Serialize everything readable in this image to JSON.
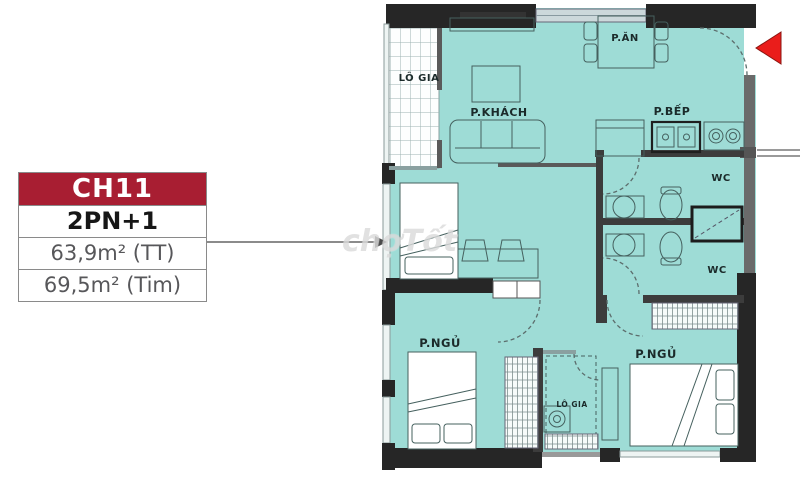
{
  "watermark": "chợTốt",
  "unit_card": {
    "code": "CH11",
    "layout_type": "2PN+1",
    "area_line1": "63,9m² (TT)",
    "area_line2": "69,5m² (Tim)",
    "header_color": "#a81e32"
  },
  "floor_plan": {
    "colors": {
      "floor": "#9edcd6",
      "wall": "#262626",
      "entrance_arrow": "#ea1d1b"
    },
    "labels": {
      "balcony_top": "LÔ GIA",
      "living_room": "P.KHÁCH",
      "dining_room": "P.ĂN",
      "kitchen": "P.BẾP",
      "wc_top": "WC",
      "wc_bottom": "WC",
      "bedroom_left": "P.NGỦ",
      "bedroom_right": "P.NGỦ",
      "balcony_bottom": "LÔ GIA"
    }
  }
}
